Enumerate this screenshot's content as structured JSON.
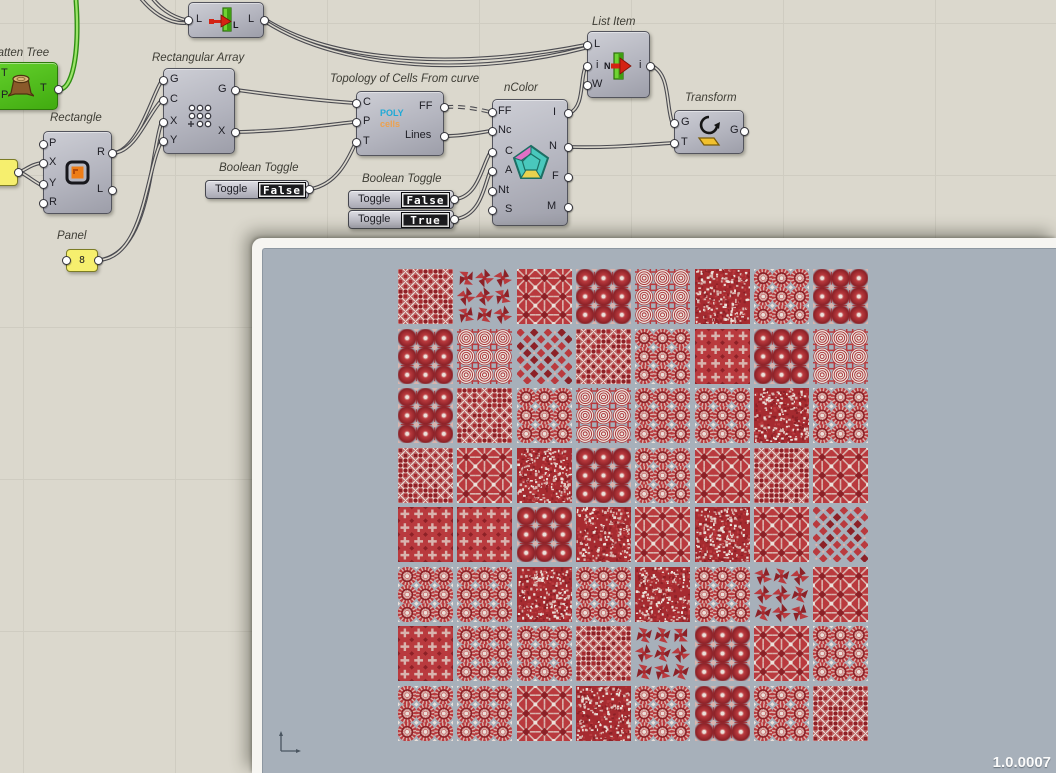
{
  "components": {
    "flatten_tree": {
      "label": "Flatten Tree",
      "inputs": [
        "T",
        "P"
      ],
      "output": "T"
    },
    "sorter": {
      "input": "L",
      "output": "L",
      "icon_letter": "L"
    },
    "rectangle": {
      "label": "Rectangle",
      "inputs": [
        "P",
        "X",
        "Y",
        "R"
      ],
      "outputs": [
        "R",
        "L"
      ]
    },
    "panel": {
      "label": "Panel",
      "value": "8"
    },
    "rectangular_array": {
      "label": "Rectangular Array",
      "inputs": [
        "G",
        "C",
        "X",
        "Y"
      ],
      "outputs": [
        "G",
        "X"
      ]
    },
    "boolean_toggle_1": {
      "label": "Boolean Toggle",
      "toggle_label": "Toggle",
      "value": "False"
    },
    "topology": {
      "label": "Topology of Cells From curve",
      "inputs": [
        "C",
        "P",
        "T"
      ],
      "outputs": [
        "FF",
        "Lines"
      ],
      "icon_top": "POLY",
      "icon_bottom": "cells"
    },
    "boolean_toggle_group": {
      "label": "Boolean Toggle",
      "toggles": [
        {
          "toggle_label": "Toggle",
          "value": "False"
        },
        {
          "toggle_label": "Toggle",
          "value": "True"
        }
      ]
    },
    "ncolor": {
      "label": "nColor",
      "inputs": [
        "FF",
        "Nc",
        "C",
        "A",
        "Nt",
        "S"
      ],
      "outputs": [
        "I",
        "N",
        "F",
        "M"
      ]
    },
    "list_item": {
      "label": "List Item",
      "inputs": [
        "L",
        "i",
        "W"
      ],
      "output": "i",
      "icon_letter": "N"
    },
    "transform": {
      "label": "Transform",
      "inputs": [
        "G",
        "T"
      ],
      "output": "G"
    }
  },
  "viewport": {
    "version": "1.0.0007",
    "bg_color": "#a7b0ba",
    "grid": {
      "rows": 8,
      "cols": 8,
      "origin_x": 135,
      "origin_y": 20,
      "pitch_x": 59.35,
      "pitch_y": 59.5,
      "tile_size": 55
    },
    "tile_palette": {
      "dark": "#8c2127",
      "mid": "#a62b30",
      "bright": "#b93a3e",
      "pale": "#d9b4ae",
      "white": "#ece1da"
    },
    "tile_types": [
      "lattice",
      "pinwheel",
      "star",
      "flower",
      "rings",
      "dense",
      "burst",
      "flower",
      "flower",
      "rings",
      "mosaic",
      "lattice",
      "burst",
      "cross",
      "flower",
      "rings",
      "flower",
      "lattice",
      "burst",
      "rings",
      "burst",
      "burst",
      "dense",
      "burst",
      "lattice",
      "star",
      "dense",
      "flower",
      "burst",
      "star",
      "lattice",
      "star",
      "cross",
      "cross",
      "flower",
      "dense",
      "star",
      "dense",
      "star",
      "mosaic",
      "burst",
      "burst",
      "dense",
      "burst",
      "dense",
      "burst",
      "pinwheel",
      "star",
      "cross",
      "burst",
      "burst",
      "lattice",
      "pinwheel",
      "flower",
      "star",
      "burst",
      "burst",
      "burst",
      "star",
      "dense",
      "burst",
      "flower",
      "burst",
      "lattice"
    ],
    "tile_seeds": [
      3,
      17,
      29,
      41,
      53,
      67,
      79,
      97,
      5,
      19,
      31,
      43,
      59,
      71,
      83,
      101,
      7,
      23,
      37,
      47,
      61,
      73,
      89,
      103,
      13,
      27,
      39,
      51,
      63,
      77,
      91,
      107,
      15,
      25,
      35,
      45,
      55,
      65,
      75,
      87,
      95,
      105,
      115,
      125,
      135,
      145,
      155,
      165,
      9,
      21,
      33,
      57,
      69,
      81,
      93,
      109,
      111,
      121,
      131,
      141,
      151,
      161,
      171,
      181
    ]
  },
  "canvas_colors": {
    "background": "#dbd8cd",
    "grid_line": "#cfccc1",
    "wire": "#4b4b51",
    "selected_wire": "#2f8f12"
  }
}
